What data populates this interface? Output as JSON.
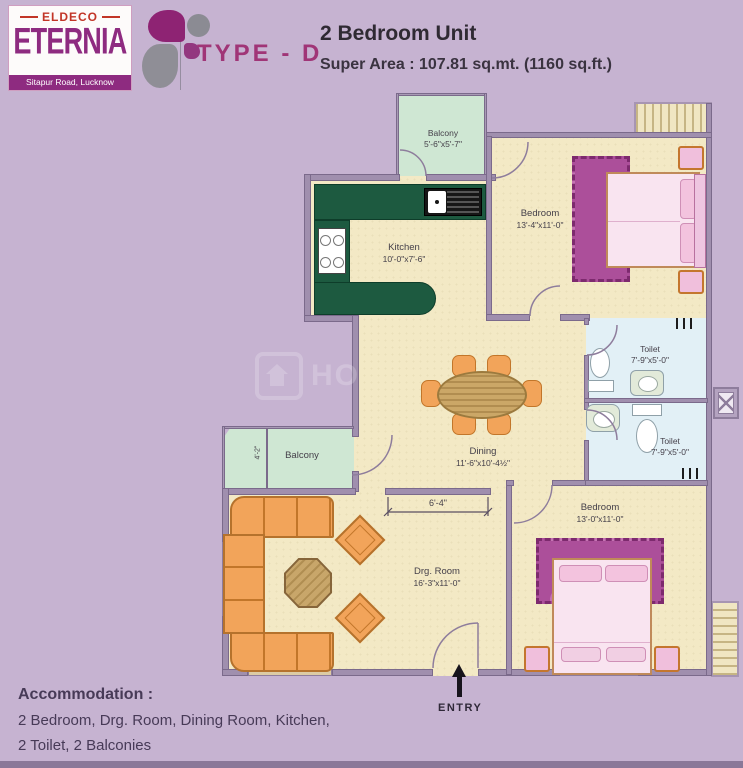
{
  "header": {
    "brand": "ELDECO",
    "project": "ETERNIA",
    "address": "Sitapur Road, Lucknow",
    "type_label": "TYPE - D",
    "unit_title": "2 Bedroom Unit",
    "super_area": "Super Area : 107.81 sq.mt. (1160 sq.ft.)"
  },
  "watermark": "HO",
  "rooms": {
    "balcony_top": {
      "name": "Balcony",
      "dim": "5'-6\"x5'-7\""
    },
    "kitchen": {
      "name": "Kitchen",
      "dim": "10'-0\"x7'-6\""
    },
    "bedroom_top": {
      "name": "Bedroom",
      "dim": "13'-4\"x11'-0\""
    },
    "toilet_top": {
      "name": "Toilet",
      "dim": "7'-9\"x5'-0\""
    },
    "toilet_bottom": {
      "name": "Toilet",
      "dim": "7'-9\"x5'-0\""
    },
    "dining": {
      "name": "Dining",
      "dim": "11'-6\"x10'-4½\""
    },
    "balcony_left": {
      "name": "Balcony",
      "dim": "4'-2\""
    },
    "drg_room": {
      "name": "Drg. Room",
      "dim": "16'-3\"x11'-0\""
    },
    "bedroom_bottom": {
      "name": "Bedroom",
      "dim": "13'-0\"x11'-0\""
    }
  },
  "annotations": {
    "passage_dim": "6'-4\"",
    "entry": "ENTRY"
  },
  "footer": {
    "heading": "Accommodation :",
    "line1": "2 Bedroom, Drg. Room, Dining Room, Kitchen,",
    "line2": "2 Toilet, 2 Balconies"
  },
  "colors": {
    "background": "#c6b3d1",
    "wall": "#a08fae",
    "floor": "#f3e9c5",
    "balcony": "#cfe7d3",
    "toilet": "#e2f0f6",
    "kitchen_counter": "#1d5a40",
    "sofa": "#f2a45a",
    "rug": "#ac4f9a",
    "bed": "#f9e4f0",
    "brand_red": "#c23527",
    "brand_purple": "#8e2b80",
    "type_magenta": "#a03577"
  }
}
